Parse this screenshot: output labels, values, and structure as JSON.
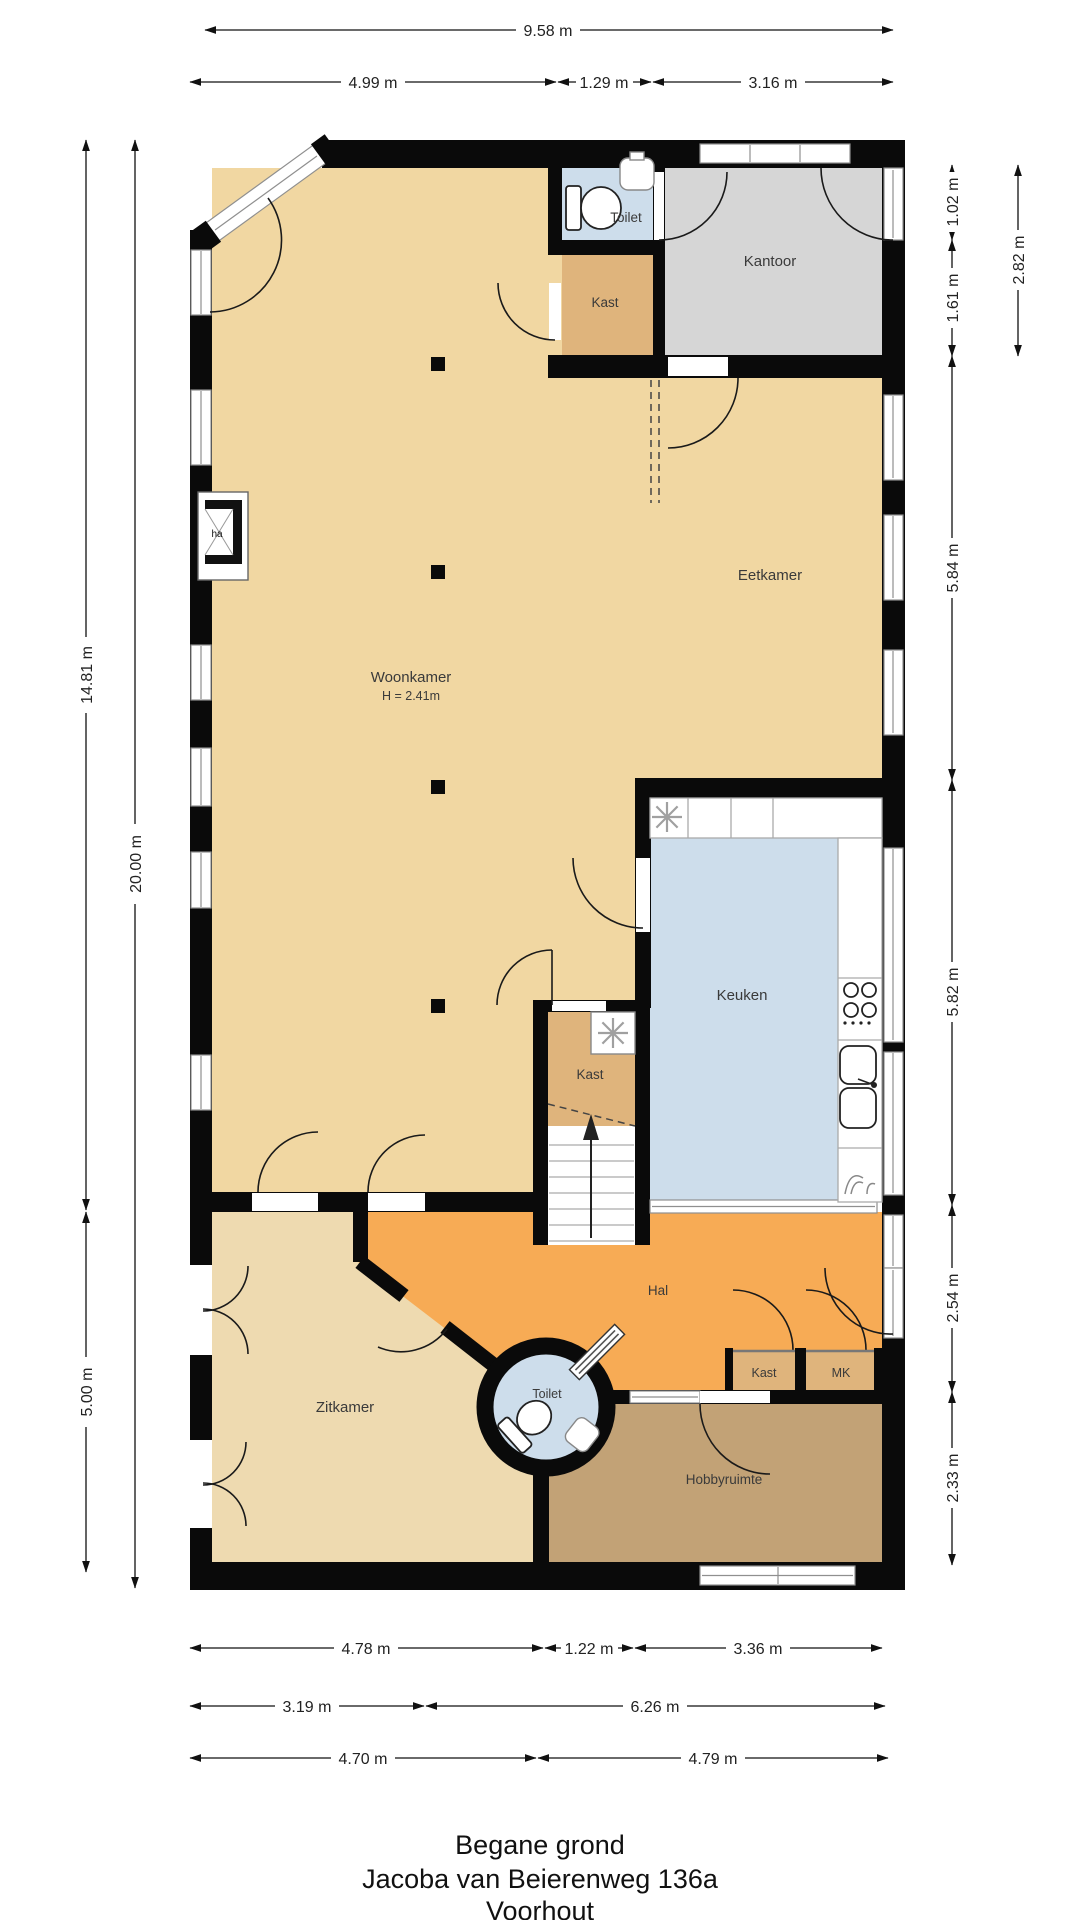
{
  "title": {
    "floor": "Begane grond",
    "address": "Jacoba van Beierenweg 136a",
    "city": "Voorhout"
  },
  "rooms": {
    "toilet_top": {
      "label": "Toilet"
    },
    "kantoor": {
      "label": "Kantoor"
    },
    "kast_top": {
      "label": "Kast"
    },
    "eetkamer": {
      "label": "Eetkamer"
    },
    "woonkamer": {
      "label": "Woonkamer",
      "height": "H = 2.41m"
    },
    "keuken": {
      "label": "Keuken"
    },
    "kast_stairs": {
      "label": "Kast"
    },
    "hal": {
      "label": "Hal"
    },
    "zitkamer": {
      "label": "Zitkamer"
    },
    "toilet_round": {
      "label": "Toilet"
    },
    "kast_hal": {
      "label": "Kast"
    },
    "meterkast": {
      "label": "MK"
    },
    "hobbyruimte": {
      "label": "Hobbyruimte"
    },
    "fireplace": {
      "label": "ha"
    }
  },
  "dimensions": {
    "top_total": "9.58 m",
    "top_segments": [
      "4.99 m",
      "1.29 m",
      "3.16 m"
    ],
    "left": [
      "14.81 m",
      "20.00 m",
      "5.00 m"
    ],
    "right": [
      "1.02 m",
      "1.61 m",
      "2.82 m",
      "5.84 m",
      "5.82 m",
      "2.54 m",
      "2.33 m"
    ],
    "bottom_row1": [
      "4.78 m",
      "1.22 m",
      "3.36 m"
    ],
    "bottom_row2": [
      "3.19 m",
      "6.26 m"
    ],
    "bottom_row3": [
      "4.70 m",
      "4.79 m"
    ]
  },
  "colors": {
    "wall": "#0a0a0a",
    "floor_tan": "#f1d7a2",
    "floor_tan_light": "#eedab0",
    "floor_brown": "#dfb47c",
    "floor_blue": "#cdddeb",
    "floor_gray": "#d6d6d6",
    "floor_orange": "#f7ab55",
    "floor_hobby": "#c2a276",
    "window_gray": "#8f8f8f",
    "dim_text": "#222222",
    "label_text": "#3a3a3a"
  }
}
